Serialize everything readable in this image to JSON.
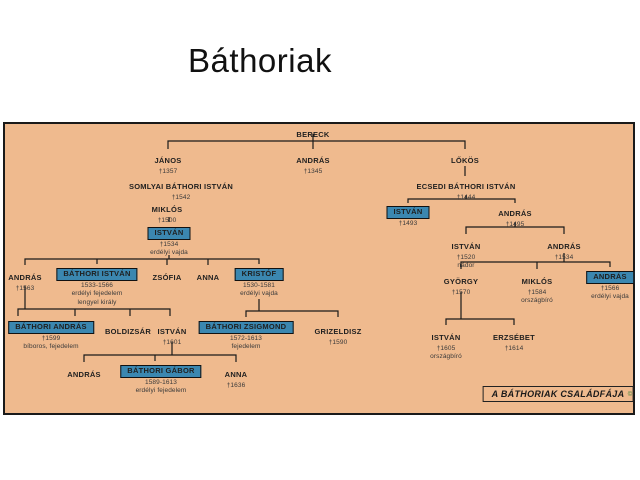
{
  "slide": {
    "title": "Báthoriak"
  },
  "panel": {
    "caption": "A BÁTHORIAK CSALÁDFÁJA",
    "watermark": "©",
    "bg_color": "#efba8e",
    "highlight_color": "#3b87b0",
    "line_color": "#1a1a1a"
  },
  "tree": {
    "nodes": [
      {
        "name": "BERECK"
      },
      {
        "name": "JÁNOS",
        "line2": "†1357"
      },
      {
        "name": "ANDRÁS",
        "line2": "†1345"
      },
      {
        "name": "LŐKÖS"
      },
      {
        "name": "SOMLYAI BÁTHORI ISTVÁN",
        "line2": "†1542"
      },
      {
        "name": "ECSEDI BÁTHORI ISTVÁN",
        "line2": "†1444"
      },
      {
        "name": "MIKLÓS",
        "line2": "†1500"
      },
      {
        "name": "ISTVÁN",
        "line2": "†1534",
        "line3": "erdélyi vajda",
        "highlighted": true
      },
      {
        "name": "ISTVÁN",
        "line2": "†1493",
        "highlighted": true
      },
      {
        "name": "ANDRÁS",
        "line2": "†1495"
      },
      {
        "name": "ISTVÁN",
        "line2": "†1520",
        "line3": "nádor"
      },
      {
        "name": "ANDRÁS",
        "line2": "†1534"
      },
      {
        "name": "GYÖRGY",
        "line2": "†1570"
      },
      {
        "name": "MIKLÓS",
        "line2": "†1584",
        "line3": "országbíró"
      },
      {
        "name": "ANDRÁS",
        "line2": "†1566",
        "line3": "erdélyi vajda",
        "highlighted": true
      },
      {
        "name": "ISTVÁN",
        "line2": "†1605",
        "line3": "országbíró"
      },
      {
        "name": "ERZSÉBET",
        "line2": "†1614"
      },
      {
        "name": "ANDRÁS",
        "line2": "†1563"
      },
      {
        "name": "BÁTHORI ISTVÁN",
        "line2": "1533-1566",
        "line3": "erdélyi fejedelem",
        "line4": "lengyel király",
        "highlighted": true
      },
      {
        "name": "ZSÓFIA"
      },
      {
        "name": "ANNA"
      },
      {
        "name": "KRISTÓF",
        "line2": "1530-1581",
        "line3": "erdélyi vajda",
        "highlighted": true
      },
      {
        "name": "BÁTHORI ANDRÁS",
        "line2": "†1599",
        "line3": "bíboros, fejedelem",
        "highlighted": true
      },
      {
        "name": "BOLDIZSÁR"
      },
      {
        "name": "ISTVÁN",
        "line2": "†1601"
      },
      {
        "name": "BÁTHORI ZSIGMOND",
        "line2": "1572-1613",
        "line3": "fejedelem",
        "highlighted": true
      },
      {
        "name": "GRIZELDISZ",
        "line2": "†1590"
      },
      {
        "name": "ANDRÁS"
      },
      {
        "name": "BÁTHORI GÁBOR",
        "line2": "1589-1613",
        "line3": "erdélyi fejedelem",
        "highlighted": true
      },
      {
        "name": "ANNA",
        "line2": "†1636"
      }
    ]
  }
}
